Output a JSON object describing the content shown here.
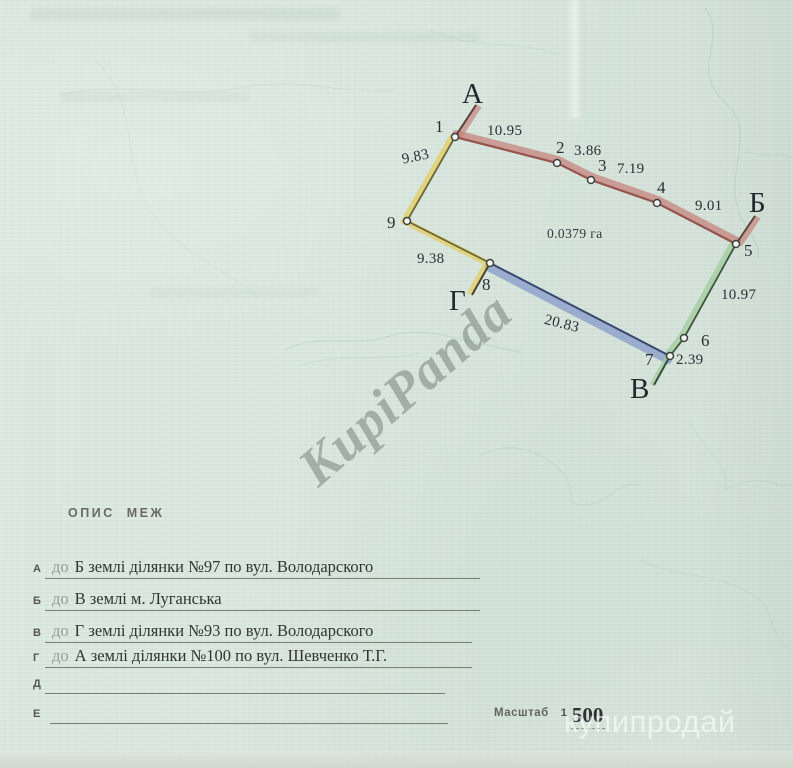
{
  "diagram": {
    "corner_labels": [
      "А",
      "Б",
      "В",
      "Г"
    ],
    "vertex_numbers": [
      "1",
      "2",
      "3",
      "4",
      "5",
      "6",
      "7",
      "8",
      "9"
    ],
    "segments": [
      {
        "from": "1",
        "to": "2",
        "length": "10.95"
      },
      {
        "from": "2",
        "to": "3",
        "length": "3.86"
      },
      {
        "from": "3",
        "to": "4",
        "length": "7.19"
      },
      {
        "from": "4",
        "to": "5",
        "length": "9.01"
      },
      {
        "from": "5",
        "to": "6",
        "length": "10.97"
      },
      {
        "from": "6",
        "to": "7",
        "length": "2.39"
      },
      {
        "from": "7",
        "to": "8",
        "length": "20.83"
      },
      {
        "from": "8",
        "to": "9",
        "length": "9.38"
      },
      {
        "from": "9",
        "to": "1",
        "length": "9.83"
      }
    ],
    "area_label": "0.0379 га",
    "edge_colors": {
      "north_boundary": "#c57e78",
      "east_boundary": "#a2cb9d",
      "south_boundary": "#8295c7",
      "west_boundary": "#e1cf6a"
    }
  },
  "legend": {
    "heading": "ОПИС МЕЖ",
    "rows": [
      {
        "label": "А",
        "prefix": "до",
        "text": "Б землі ділянки №97 по вул. Володарского"
      },
      {
        "label": "Б",
        "prefix": "до",
        "text": "В землі м. Луганська"
      },
      {
        "label": "В",
        "prefix": "до",
        "text": "Г землі ділянки №93 по вул. Володарского"
      },
      {
        "label": "Г",
        "prefix": "до",
        "text": "А землі ділянки №100 по вул. Шевченко Т.Г."
      },
      {
        "label": "Д",
        "prefix": "",
        "text": ""
      },
      {
        "label": "Е",
        "prefix": "",
        "text": ""
      }
    ],
    "scale_label": "Масштаб",
    "scale_one": "1",
    "scale_value": "500"
  },
  "watermarks": {
    "diagonal": "KupiPanda",
    "site": "купипродай"
  }
}
